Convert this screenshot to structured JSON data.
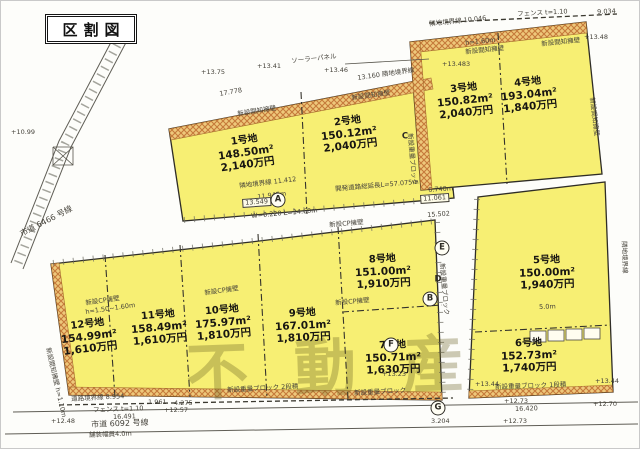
{
  "title": "区割図",
  "watermark": "不動産",
  "colors": {
    "lot_fill": "#f7ef73",
    "hatch_orange": "#c5793a",
    "paper": "#fdfdfa",
    "line": "#2f2d26",
    "watermark": "#685e1e"
  },
  "lots": [
    {
      "name": "1号地",
      "area": "148.50m²",
      "price": "2,140万円",
      "x": 245,
      "y": 152,
      "r": -8
    },
    {
      "name": "2号地",
      "area": "150.12m²",
      "price": "2,040万円",
      "x": 348,
      "y": 133,
      "r": -7
    },
    {
      "name": "3号地",
      "area": "150.82m²",
      "price": "2,040万円",
      "x": 464,
      "y": 100,
      "r": -6
    },
    {
      "name": "4号地",
      "area": "193.04m²",
      "price": "1,840万円",
      "x": 528,
      "y": 94,
      "r": -6
    },
    {
      "name": "5号地",
      "area": "150.00m²",
      "price": "1,940万円",
      "x": 546,
      "y": 272,
      "r": -2
    },
    {
      "name": "6号地",
      "area": "152.73m²",
      "price": "1,740万円",
      "x": 528,
      "y": 355,
      "r": -2
    },
    {
      "name": "7号地",
      "area": "150.71m²",
      "price": "1,630万円",
      "x": 392,
      "y": 357,
      "r": -2
    },
    {
      "name": "8号地",
      "area": "151.00m²",
      "price": "1,910万円",
      "x": 382,
      "y": 271,
      "r": -3
    },
    {
      "name": "9号地",
      "area": "167.01m²",
      "price": "1,810万円",
      "x": 302,
      "y": 325,
      "r": -3
    },
    {
      "name": "10号地",
      "area": "175.97m²",
      "price": "1,810万円",
      "x": 222,
      "y": 322,
      "r": -5
    },
    {
      "name": "11号地",
      "area": "158.49m²",
      "price": "1,610万円",
      "x": 158,
      "y": 327,
      "r": -5
    },
    {
      "name": "12号地",
      "area": "154.99m²",
      "price": "1,610万円",
      "x": 88,
      "y": 336,
      "r": -7
    }
  ],
  "markers": [
    {
      "l": "A",
      "x": 277,
      "y": 199,
      "circ": true
    },
    {
      "l": "B",
      "x": 429,
      "y": 298,
      "circ": true
    },
    {
      "l": "C",
      "x": 404,
      "y": 136,
      "circ": false
    },
    {
      "l": "D",
      "x": 437,
      "y": 279,
      "circ": false
    },
    {
      "l": "E",
      "x": 441,
      "y": 247,
      "circ": true
    },
    {
      "l": "F",
      "x": 390,
      "y": 344,
      "circ": true
    },
    {
      "l": "G",
      "x": 437,
      "y": 407,
      "circ": true
    }
  ],
  "annotations": [
    {
      "t": "ソーラーパネル",
      "x": 290,
      "y": 57,
      "r": -6
    },
    {
      "t": "フェンス t=1.10",
      "x": 516,
      "y": 10,
      "r": -3
    },
    {
      "t": "9.034",
      "x": 596,
      "y": 8,
      "r": -3
    },
    {
      "t": "隣地境界線 10.046",
      "x": 428,
      "y": 20,
      "r": -6
    },
    {
      "t": "+13.48",
      "x": 583,
      "y": 33,
      "r": 0
    },
    {
      "t": "h=1.60m",
      "x": 464,
      "y": 39,
      "r": -6
    },
    {
      "t": "新設間知擁壁",
      "x": 464,
      "y": 48,
      "r": -6
    },
    {
      "t": "新設間知擁壁",
      "x": 540,
      "y": 40,
      "r": -6
    },
    {
      "t": "+13.483",
      "x": 441,
      "y": 60,
      "r": 0
    },
    {
      "t": "+13.75",
      "x": 200,
      "y": 68,
      "r": 0
    },
    {
      "t": "+13.41",
      "x": 256,
      "y": 62,
      "r": 0
    },
    {
      "t": "+13.46",
      "x": 323,
      "y": 66,
      "r": 0
    },
    {
      "t": "17.778",
      "x": 218,
      "y": 90,
      "r": -10
    },
    {
      "t": "13.160 隣地境界線",
      "x": 356,
      "y": 74,
      "r": -8
    },
    {
      "t": "新設間知擁壁",
      "x": 236,
      "y": 110,
      "r": -9
    },
    {
      "t": "新設間知擁壁",
      "x": 350,
      "y": 94,
      "r": -8
    },
    {
      "t": "新設間知擁壁",
      "x": 594,
      "y": 96,
      "r": 83
    },
    {
      "t": "隣地境界線",
      "x": 626,
      "y": 240,
      "r": 88
    },
    {
      "t": "隣地境界線 11.412",
      "x": 238,
      "y": 182,
      "r": -7
    },
    {
      "t": "11.945m",
      "x": 256,
      "y": 193,
      "r": -7
    },
    {
      "t": "開発道路総延長L=57.075m",
      "x": 334,
      "y": 185,
      "r": -5
    },
    {
      "t": "6.740m",
      "x": 427,
      "y": 186,
      "r": -4
    },
    {
      "t": "13.549",
      "x": 241,
      "y": 198,
      "r": -4,
      "boxed": true
    },
    {
      "t": "11.061",
      "x": 419,
      "y": 194,
      "r": -4,
      "boxed": true
    },
    {
      "t": "W=0.220 L=34.60m",
      "x": 250,
      "y": 212,
      "r": -5
    },
    {
      "t": "15.502",
      "x": 426,
      "y": 211,
      "r": -4
    },
    {
      "t": "新設CP擁壁",
      "x": 328,
      "y": 221,
      "r": -5
    },
    {
      "t": "市道 6466 号線",
      "x": 18,
      "y": 230,
      "r": -27,
      "s": 8
    },
    {
      "t": "+10.99",
      "x": 10,
      "y": 128,
      "r": 0
    },
    {
      "t": "新設CP擁壁",
      "x": 84,
      "y": 299,
      "r": -8
    },
    {
      "t": "h=1.50~1.60m",
      "x": 84,
      "y": 308,
      "r": -8
    },
    {
      "t": "新設CP擁壁",
      "x": 203,
      "y": 289,
      "r": -8
    },
    {
      "t": "新設CP擁壁",
      "x": 334,
      "y": 299,
      "r": -5
    },
    {
      "t": "新設間知擁壁 h=1.10m",
      "x": 50,
      "y": 346,
      "r": 77
    },
    {
      "t": "新設重量ブロック",
      "x": 444,
      "y": 262,
      "r": 85
    },
    {
      "t": "新設重量ブロック",
      "x": 412,
      "y": 132,
      "r": 85
    },
    {
      "t": "+13.23",
      "x": 381,
      "y": 370,
      "r": 0
    },
    {
      "t": "+13.44",
      "x": 474,
      "y": 380,
      "r": 0
    },
    {
      "t": "+13.44",
      "x": 594,
      "y": 377,
      "r": 0
    },
    {
      "t": "5.0m",
      "x": 538,
      "y": 303,
      "r": -2
    },
    {
      "t": "新設重量ブロック 2段積",
      "x": 226,
      "y": 386,
      "r": -3
    },
    {
      "t": "新設重量ブロック",
      "x": 353,
      "y": 389,
      "r": -3
    },
    {
      "t": "新設重量ブロック 1段積",
      "x": 494,
      "y": 383,
      "r": -2
    },
    {
      "t": "道路境界線 8.954",
      "x": 70,
      "y": 395,
      "r": -3
    },
    {
      "t": "1.961",
      "x": 147,
      "y": 398,
      "r": 0
    },
    {
      "t": "4.275",
      "x": 173,
      "y": 399,
      "r": 0
    },
    {
      "t": "フェンス t=1.10",
      "x": 92,
      "y": 406,
      "r": -2
    },
    {
      "t": "16.491",
      "x": 112,
      "y": 413,
      "r": -2
    },
    {
      "t": "+12.48",
      "x": 50,
      "y": 417,
      "r": 0
    },
    {
      "t": "市道 6092 号線",
      "x": 90,
      "y": 420,
      "r": -2,
      "s": 8
    },
    {
      "t": "舗装幅員4.0m",
      "x": 88,
      "y": 431,
      "r": -2
    },
    {
      "t": "+12.57",
      "x": 163,
      "y": 406,
      "r": 0
    },
    {
      "t": "3.204",
      "x": 430,
      "y": 417,
      "r": 0
    },
    {
      "t": "+12.73",
      "x": 503,
      "y": 397,
      "r": 0
    },
    {
      "t": "16.420",
      "x": 514,
      "y": 405,
      "r": -2
    },
    {
      "t": "+12.73",
      "x": 502,
      "y": 417,
      "r": 0
    },
    {
      "t": "+12.70",
      "x": 592,
      "y": 400,
      "r": 0
    }
  ],
  "map": {
    "blocks": [
      "168,128 430,77 436,170 450,168 453,197 182,220",
      "409,41 585,21 601,173 420,189",
      "477,196 604,181 612,391 468,397",
      "50,263 250,241 434,219 441,399 68,394"
    ],
    "hatches": [
      "168,128 430,77 432,88 170,139",
      "409,41 585,21 586,32 410,52",
      "409,41 419,40 431,188 420,189",
      "50,263 58,262 76,393 68,394",
      "68,394 441,399 441,391 69,386",
      "468,397 612,391 611,384 468,390"
    ],
    "lines": [
      {
        "p": "118,26 58,140 10,262",
        "c": "rail"
      },
      {
        "p": "130,32 70,146 22,268",
        "c": "rail"
      },
      {
        "p": "124,29 64,143 16,265",
        "c": "ladder"
      },
      {
        "p": "12,411 637,401",
        "c": "rail"
      },
      {
        "p": "4,433 637,423",
        "c": "rail"
      },
      {
        "p": "58,404 452,397",
        "c": "fence"
      },
      {
        "p": "428,22 616,13",
        "c": "fence"
      },
      {
        "p": "344,63 428,58",
        "c": "thin"
      },
      {
        "p": "52,146 72,146 72,164 52,164 52,146",
        "c": "thin"
      },
      {
        "p": "52,146 72,164",
        "c": "thin"
      },
      {
        "p": "72,146 52,164",
        "c": "thin"
      },
      {
        "p": "300,91 306,213",
        "c": "dash"
      },
      {
        "p": "497,32 506,183",
        "c": "dash"
      },
      {
        "p": "474,331 610,324",
        "c": "dash"
      },
      {
        "p": "337,226 347,398",
        "c": "dash"
      },
      {
        "p": "341,311 441,304",
        "c": "dash"
      },
      {
        "p": "257,233 266,397",
        "c": "dash"
      },
      {
        "p": "179,244 189,396",
        "c": "dash"
      },
      {
        "p": "104,254 114,396",
        "c": "dash"
      },
      {
        "p": "52,262 434,220",
        "c": "tick"
      },
      {
        "p": "183,219 452,197",
        "c": "tick"
      },
      {
        "p": "436,221 442,398",
        "c": "tick"
      },
      {
        "p": "476,198 469,396",
        "c": "tick"
      }
    ],
    "rects": [
      {
        "x": 529,
        "y": 330,
        "w": 16,
        "h": 11
      },
      {
        "x": 547,
        "y": 329,
        "w": 16,
        "h": 11
      },
      {
        "x": 565,
        "y": 328,
        "w": 16,
        "h": 11
      },
      {
        "x": 583,
        "y": 327,
        "w": 16,
        "h": 11
      }
    ]
  }
}
